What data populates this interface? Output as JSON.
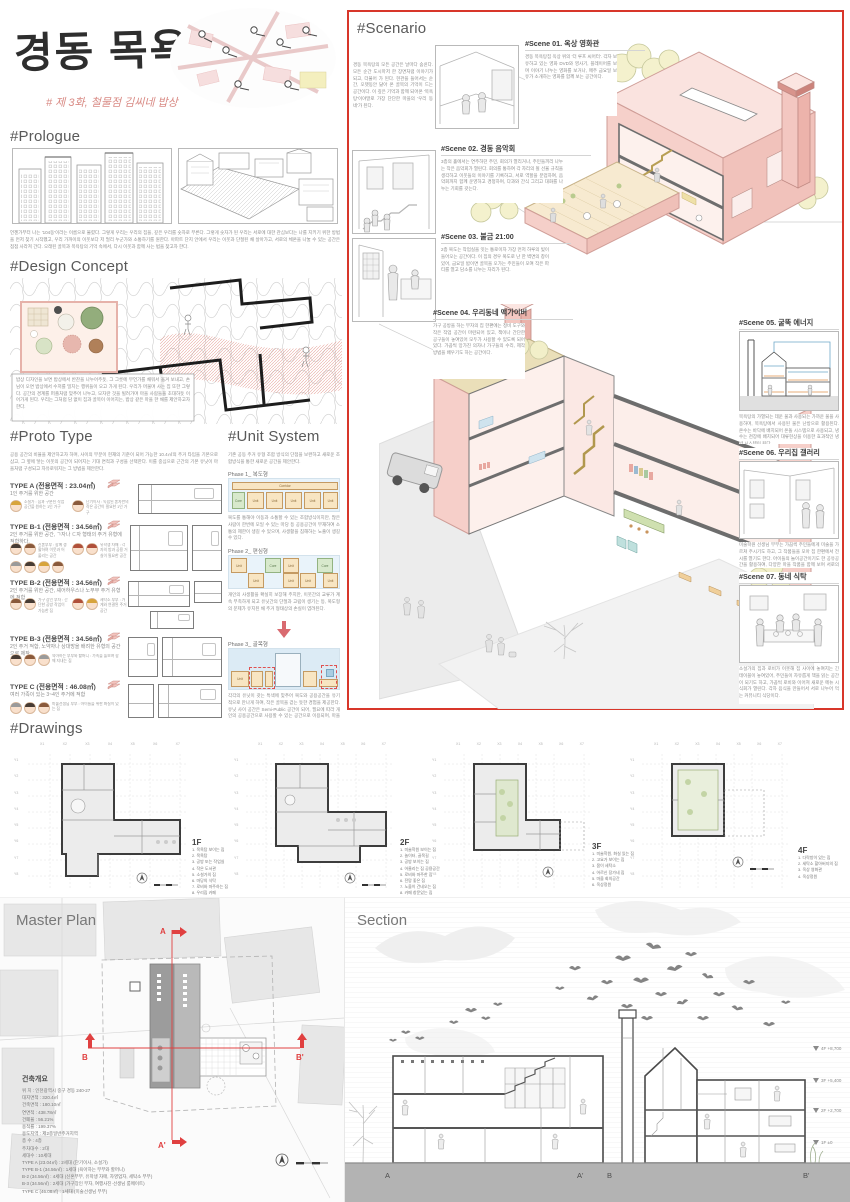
{
  "header": {
    "title": "경동 목욕탕",
    "subtitle": "# 제 3화, 철물점 김씨네 밥상"
  },
  "colors": {
    "accent_red": "#d8362a",
    "wall_pink": "#f6d0ca",
    "slab_gray": "#6e6e6e",
    "tree_green": "#f2efc9",
    "section_red_line": "#e04040"
  },
  "sections": {
    "prologue": {
      "heading": "#Prologue",
      "text": "언젠가부터 나는 '104동'이라는 이름으로 불렸다. 그렇게 우리는 우리의 집을, 깊은 우리를 숫자로 부른다. 그렇게 숫자가 된 우리는 서로에 대한 관심보다는 나를 지키기 위한 방법을 먼저 찾기 시작했고, 우리 가까이의 이웃보다 저 멀리 누군가와 소통하기를 원한다. 아파트 단지 안에서 우리는 이웃과 단절된 채 살아가고, 서로의 체온을 나눌 수 있는 공간은 점점 사라져 간다. 오래된 골목과 목욕탕의 기억 속에서, 다시 이웃과 함께 사는 법을 찾고자 한다."
    },
    "design_concept": {
      "heading": "#Design Concept",
      "text": "밥상 디자인을 보면 밥상에서 반찬을 나누어주듯, 그 그릇에 무언가를 채워서 옮겨 보내고, 손님이 오면 밥상에서 수저를 밀치는 행위들이 오고 가게 된다. 우리가 머물며 사는 집 또한 그렇다. 공간의 경계를 퍼즐처럼 맞추어 나누고, 모자란 것을 빌려가며 마을 사람들을 초대하듯 이어가게 된다. 우리는 그처럼 담 없이 집과 골목이 이어지는, 밥상 같은 마을 한 채를 제안하고자 한다."
    },
    "proto_type": {
      "heading": "#Proto Type",
      "intro": "공용 공간의 비율을 제안하고자 하며, 사이의 부분이 현재의 기준이 되어 가능한 10.4㎡의 주거 타입을 기본으로 삼고, 그 옆에 닿는 이웃의 공간이 되어지는 기대 면적과 구성을 선택한다. 이를 중심으로 근간의 기본 유닛이 마을처럼 구성되고 자유로워지는 그 방법을 제안한다.",
      "types": [
        {
          "name": "TYPE A (전용면적 : 23.04㎡)",
          "desc": "1인 주거를 위한 공간",
          "persons": [
            "소설가 : 집과 구분된 작업 공간을 원하는 1인 가구",
            "단기이사 : 독립된 혼자만의 작은 공간이 필요한 1인 가구"
          ]
        },
        {
          "name": "TYPE B-1 (전용면적 : 34.56㎡)",
          "desc": "2인 주거를 위한 공간, ㄱ자나 ㄷ자 형태의 주거 유형에 적합하다.",
          "persons": [
            "신혼부부 : 함께 생활하며 이웃과 어울리는 공간",
            "유학생 자매 : 각자의 방과 공용 거실이 필요한 공간"
          ]
        },
        {
          "name": "TYPE B-2 (전용면적 : 34.56㎡)",
          "desc": "2인 주거를 위한 공간, 셰어하우스나 노부부 주거 유형에 적합",
          "persons": [
            "가구 장인 부자 : 간단한 공방 작업이 가능한 집",
            "세탁소 부부 : 가게와 연결된 주거 공간"
          ]
        },
        {
          "name": "TYPE B-3 (전용면적 : 34.56㎡)",
          "desc": "2인 주거 적합, 노약자나 상대방을 배려한 유형의 공간으로 제작",
          "persons": [
            "육아하는 부부와 할머니 : 가족을 돌보며 함께 지내는 집"
          ]
        },
        {
          "name": "TYPE C (전용면적 : 46.08㎡)",
          "desc": "여러 가족이 있는 3~4인 주거에 적합",
          "persons": [
            "미술선생님 부부 : 아이들을 위한 화실이 있는 집"
          ]
        }
      ]
    },
    "unit_system": {
      "heading": "#Unit System",
      "intro": "기존 공동 주거 유형 조합 방식의 단점을 보완하고 새로운 조합방식을 통한 새로운 공간을 제안한다.",
      "corridor_label": "Corridor",
      "core_label": "Core",
      "unit_label": "Unit",
      "phases": [
        {
          "label": "Phase 1_ 복도형",
          "text": "복도를 통해야 이동과 소통할 수 있는 조합방식이지만, 많은 사람이 한번에 모일 수 있는 마당 등 공용공간이 부재하여 소통의 제한이 생길 수 있으며, 사생활을 침해하는 노출이 생길 수 있다."
        },
        {
          "label": "Phase 2_ 편심형",
          "text": "개인의 사생활을 확실히 보장해 주지만, 이웃간의 교류가 계속 부족하게 되고 유닛간의 단절과 고립이 생기는 등, 복도형의 문제가 유지된 채 주거 형태상의 손실이 염려된다."
        },
        {
          "label": "Phase 3_ 골목형",
          "text": "각각의 유닛이 갖는 특색에 맞추어 복도와 공용공간을 유기적으로 만나게 하여, 작은 골목을 걷는 듯한 경험을 제공한다. 유닛 사이 공간은 Semi-Public 공간이 되어, 필요에 따라 개인의 공용공간으로 사용할 수 있는 공간으로 이용되며, 마을의 분위기가 풍부해지는 공간이 형성된다."
        }
      ]
    },
    "scenario": {
      "heading": "#Scenario",
      "intro": "경동 목욕탕의 모든 공간은 날마다 숨쉰다. 모든 순간 도시마저 한 장면처럼 이야기가 되고, 더불어 가 된다. 현관을 들어서는 순간, 오랫동안 닳아 온 골목의 기억이 드는 공간이다. 이 깊은 기억과 함께 되어온 '목욕탕'이야말로 가장 단단한 마을의 '우리 동네'가 된다.",
      "scenes": [
        {
          "title": "#Scene 01. 옥상 영화관",
          "text": "경동 목욕탕집 옥상 위의 '더 루프 씨어터'. 각자 보유하고 있는 영화 DVD와 영사기, 플레이어를 보며 이야기 나누는 영화를 보거나, 매주 금요일 보유가 소개하는 영화를 함께 보는 공간이다."
        },
        {
          "title": "#Scene 02. 경동 음악회",
          "text": "3층의 홀에서는 연주하던 주민, 회의가 열리거나, 주민들끼리 나누는 작은 음악회가 열린다. 회의를 통하여 각 자리의 될 선율 규칙을 생각하고 이웃들의 이야기를 기록하고, 서로 역할을 분업하여, 음악회까지 함께 운영하고 경청하며, 다과와 간식 그리고 대화를 나누는 기회를 갖는다."
        },
        {
          "title": "#Scene 03. 불금 21:00",
          "text": "2층 복도는 작업실을 잇는 통로이자 가장 먼저 하루의 빛이 들어오는 공간이다. 이 집의 경우 복도로 난 한 벽면의 창이 있어, 금요일 밤이면 골목을 오가는 주민들이 모여 작은 파티를 열고 담소를 나누는 자리가 된다."
        },
        {
          "title": "#Scene 04. 우리동네 맥가이버",
          "text": "가구 공방을 하는 부자의 집 한편에는 정비 도구와 작은 작업 공간이 마련되어 있고, 책이나 간단한 공구들이 놓여있어 모두가 사용할 수 있도록 되어 있다. 가끔씩 망가진 의자나 가구들의 수리, 제작 방법을 배우기도 하는 공간이다."
        },
        {
          "title": "#Scene 05. 굴뚝 에너지",
          "text": "목욕탕의 가열되는 데운 물과 사용되는 가까운 물을 사용하며, 목욕탕에서 사용된 물은 난방으로 활용된다. 온수는 바닥에 배치되어 온돌 시스템으로 사용되고, 냉수는 천장에 배치되어 대류현상을 이용한 효과적인 냉방 시스템이 된다."
        },
        {
          "title": "#Scene 06. 우리집 갤러리",
          "text": "미술학원 선생님 부부는 가끔씩 주민들에게 미술을 가르쳐 주시기도 하고, 그 작품들을 모아 집 한편에서 전시를 열기도 한다. 아이들의 놀이공간이기도 한 공유공간을 활용하여, 다양한 마을 작품을 함께 보며 서로의 문화적 삶을 넓힌다."
        },
        {
          "title": "#Scene 07. 동네 식탁",
          "text": "소설가의 집과 로비가 이웃해 집 사이에 놓여지는 긴 테이블이 놓여있어, 주민들이 자유롭게 책을 읽는 공간이 되기도 하고, 가끔씩 로비와 이어져 새로운 메뉴 시식회가 열린다. 각자 음식을 만들어서 서로 나누어 먹는 커뮤니티 식당이다."
        }
      ]
    },
    "drawings": {
      "heading": "#Drawings",
      "grid_x": [
        "X1",
        "X2",
        "X3",
        "X4",
        "X5",
        "X6",
        "X7"
      ],
      "grid_y": [
        "Y1",
        "Y2",
        "Y3",
        "Y4",
        "Y5",
        "Y6",
        "Y7",
        "Y8"
      ],
      "plans": [
        {
          "label": "1F",
          "legend": [
            "1. 목욕탕 보이는 집",
            "2. 목욕탕",
            "3. 공방 또는 작업실",
            "4. 작은 도서관",
            "5. 소설가의 집",
            "6. 마당의 식탁",
            "7. 로비와 마주하는 집",
            "8. 우리집 카페"
          ]
        },
        {
          "label": "2F",
          "legend": [
            "1. 미술학원 보이는 집",
            "2. 놀이터, 골목길",
            "3. 공방 보이는 집",
            "4. 어울리는 집 공용공간",
            "5. 로비와 마주한 집",
            "6. 전망 좋은 집",
            "7. 노을이 건네오는 집",
            "8. 카페 창문있는 집"
          ]
        },
        {
          "label": "3F",
          "legend": [
            "1. 미술학원, 화실 있는 집",
            "2. 고요가 보이는 집",
            "3. 몸이 세탁소",
            "4. 어르신 장가네 집",
            "5. 마을 회의공간",
            "6. 옥상정원"
          ]
        },
        {
          "label": "4F",
          "legend": [
            "1. 다락방이 있는 집",
            "2. 세탁소 할아버지의 집",
            "3. 옥상 영화관",
            "4. 옥상정원"
          ]
        }
      ]
    },
    "master_plan": {
      "heading": "Master Plan",
      "overview_title": "건축개요",
      "overview": [
        "위 치 : 인천광역시 중구 경동 240-27",
        "대지면적 : 320.4㎡",
        "건축면적 : 180.10㎡",
        "연면적 : 438.78㎡",
        "건폐율 : 56.21%",
        "용적률 : 199.37%",
        "용도지역 : 제2종일반주거지역",
        "층 수 : 4층",
        "주차대수 : 2대",
        "세대수 : 10세대",
        "TYPE A (23.04㎡) : 2세대 (단기이사, 소설가)",
        "TYPE B-1 (34.56㎡) : 1세대 (육아하는 부부와 할머니)",
        "B-2 (34.56㎡) : 4세대 (신혼부부, 유학생 자매, 자영업자, 세탁소 부부)",
        "B-3 (34.56㎡) : 2세대 (가구장인 부자, 여행사진·선생님 룸메이트)",
        "TYPE C (46.08㎡) : 1세대 (미술선생님 부부)"
      ],
      "cut_labels": [
        "A",
        "A'",
        "B",
        "B'"
      ]
    },
    "section_view": {
      "heading": "Section",
      "cut_labels": [
        "A",
        "A'",
        "B",
        "B'"
      ],
      "levels": [
        "4F +8,700",
        "3F +5,400",
        "2F +2,700",
        "1F ±0"
      ]
    }
  }
}
